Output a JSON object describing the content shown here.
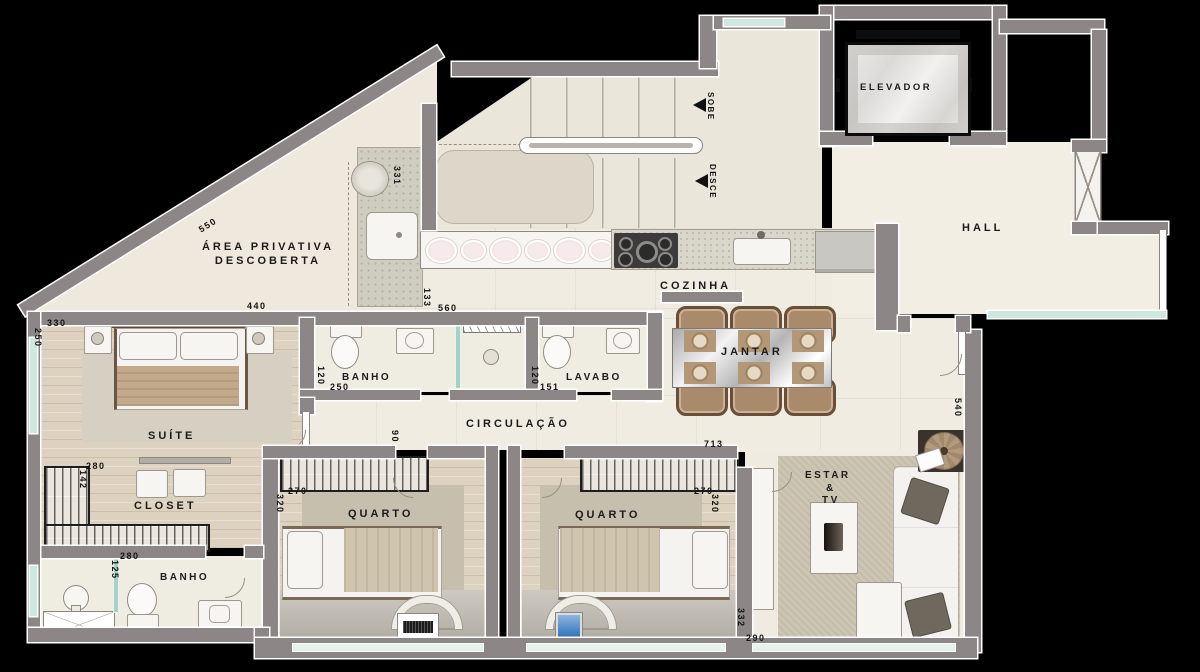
{
  "rooms": {
    "elevador": "ELEVADOR",
    "hall": "HALL",
    "area_privativa_line1": "ÁREA PRIVATIVA",
    "area_privativa_line2": "DESCOBERTA",
    "cozinha": "COZINHA",
    "jantar": "JANTAR",
    "banho_suite": "BANHO",
    "lavabo": "LAVABO",
    "circulacao": "CIRCULAÇÃO",
    "suite": "SUÍTE",
    "closet": "CLOSET",
    "banho_social": "BANHO",
    "quarto_1": "QUARTO",
    "quarto_2": "QUARTO",
    "estar_line1": "ESTAR",
    "estar_line2": "&",
    "estar_line3": "TV"
  },
  "stairs": {
    "sobe": "SOBE",
    "desce": "DESCE"
  },
  "dims": {
    "diag_550": "550",
    "suite_top_440": "440",
    "terrace_331": "331",
    "suite_330": "330",
    "suite_left_250": "250",
    "kitchen_133": "133",
    "banho_top_560": "560",
    "banho_120": "120",
    "banho_250": "250",
    "lavabo_120": "120",
    "lavabo_151": "151",
    "circ_90": "90",
    "circ_713": "713",
    "estar_540": "540",
    "closet_280": "280",
    "closet_142": "142",
    "q1_270": "270",
    "q1_320": "320",
    "q2_270": "270",
    "q2_320": "320",
    "banho2_280": "280",
    "banho2_125": "125",
    "estar_332": "332",
    "estar_290": "290"
  },
  "colors": {
    "wall": "#8d8686",
    "floor": "#f0ece1",
    "wood": "#dcd2bf",
    "glass": "#cfe8df",
    "granite": "#d8d4c6",
    "stove": "#3c3b39",
    "chair": "#a98a6a",
    "blanket": "#c3a98b"
  }
}
